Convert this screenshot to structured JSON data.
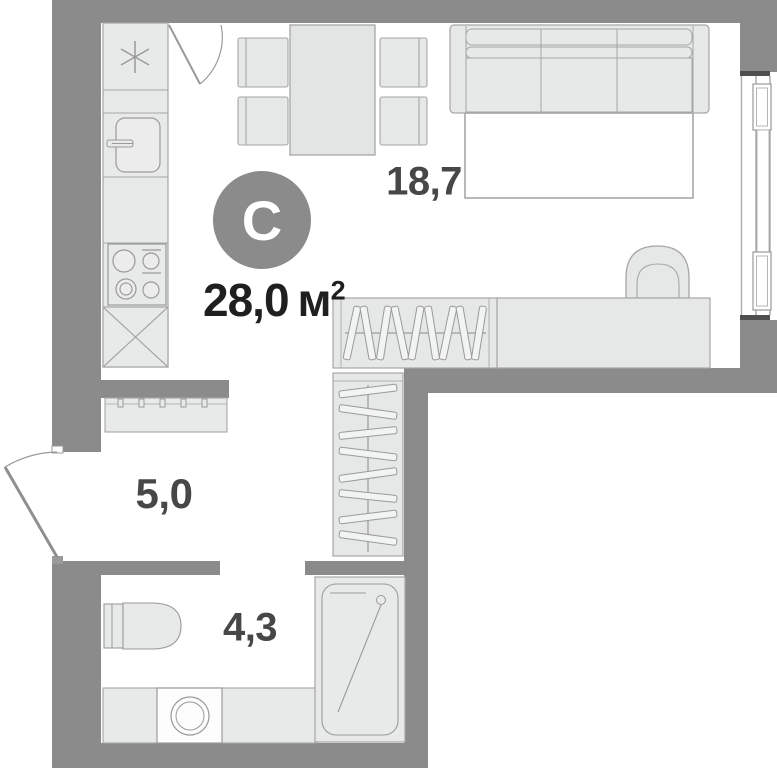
{
  "plan": {
    "unit_type_badge": "С",
    "total_area": {
      "value": "28,0",
      "unit": "м",
      "superscript": "2"
    },
    "rooms": [
      {
        "name": "living-room",
        "area": "18,7"
      },
      {
        "name": "hallway",
        "area": "5,0"
      },
      {
        "name": "bathroom",
        "area": "4,3"
      }
    ],
    "colors": {
      "wall": "#8b8b8b",
      "furniture_fill": "#e8e9e9",
      "furniture_stroke": "#a6a6a6",
      "detail_stroke": "#9a9a9a",
      "window_cap": "#4f4f4f",
      "room_label_text": "#474747",
      "total_area_text": "#1f1f1f",
      "badge_background": "#8b8b8b",
      "badge_text": "#ffffff",
      "floor": "#ffffff"
    }
  }
}
